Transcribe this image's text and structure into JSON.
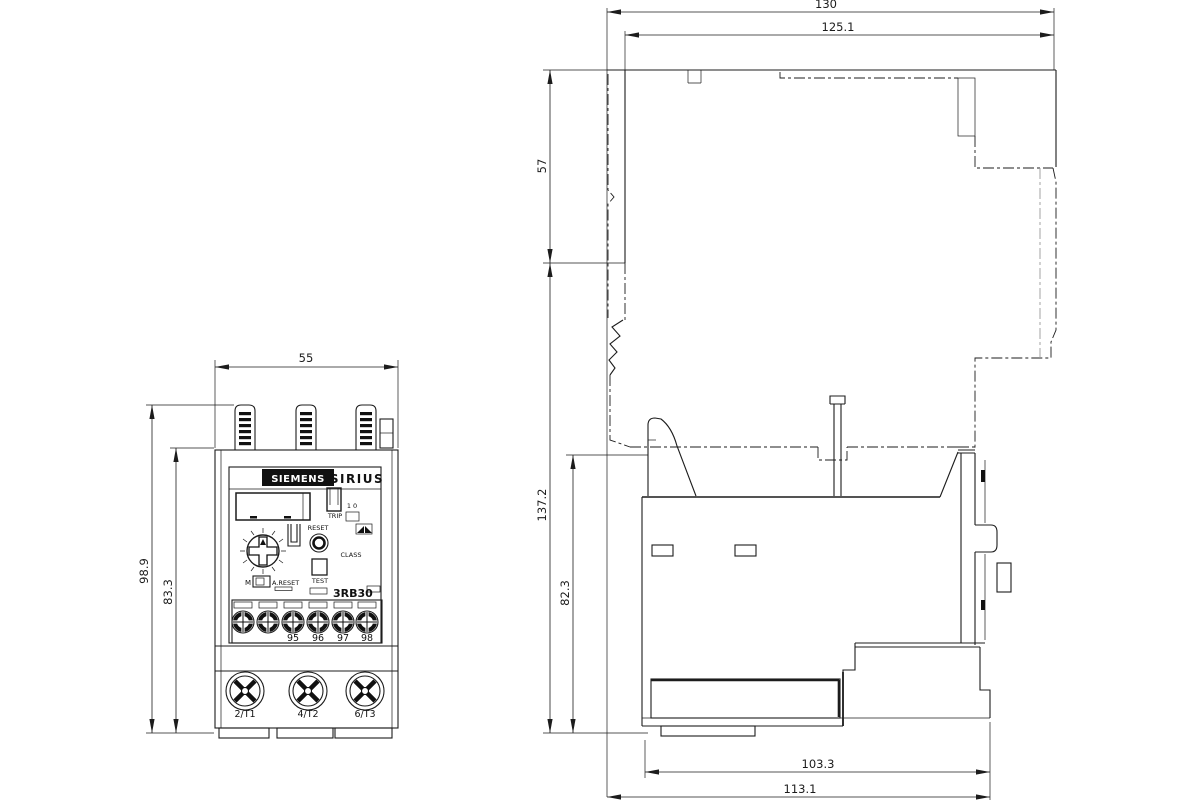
{
  "style": {
    "background": "#ffffff",
    "line_color": "#1c1c1c"
  },
  "icons": {
    "aux_screw": "plus-slot-screw",
    "main_screw": "cross-slot-screw",
    "remote_reset": "dark-flag-symbol",
    "dial": "notched-adjustment-dial"
  },
  "front": {
    "brand": "SIEMENS",
    "series": "SIRIUS",
    "model": "3RB30",
    "trip_label": "TRIP",
    "trip_states": "1 0",
    "reset_label": "RESET",
    "class_label": "CLASS",
    "test_label": "TEST",
    "manual_label": "M",
    "auto_reset_label": "A.RESET",
    "aux_terminals": [
      "95",
      "96",
      "97",
      "98"
    ],
    "main_terminals": [
      "2/T1",
      "4/T2",
      "6/T3"
    ],
    "dim_width": "55",
    "dim_height_total": "98.9",
    "dim_height_body": "83.3"
  },
  "side": {
    "dim_depth_total": "130",
    "dim_depth_front": "125.1",
    "dim_height_upper": "57",
    "dim_height_total": "137.2",
    "dim_height_relay": "82.3",
    "dim_depth_body": "103.3",
    "dim_depth_overall": "113.1"
  }
}
